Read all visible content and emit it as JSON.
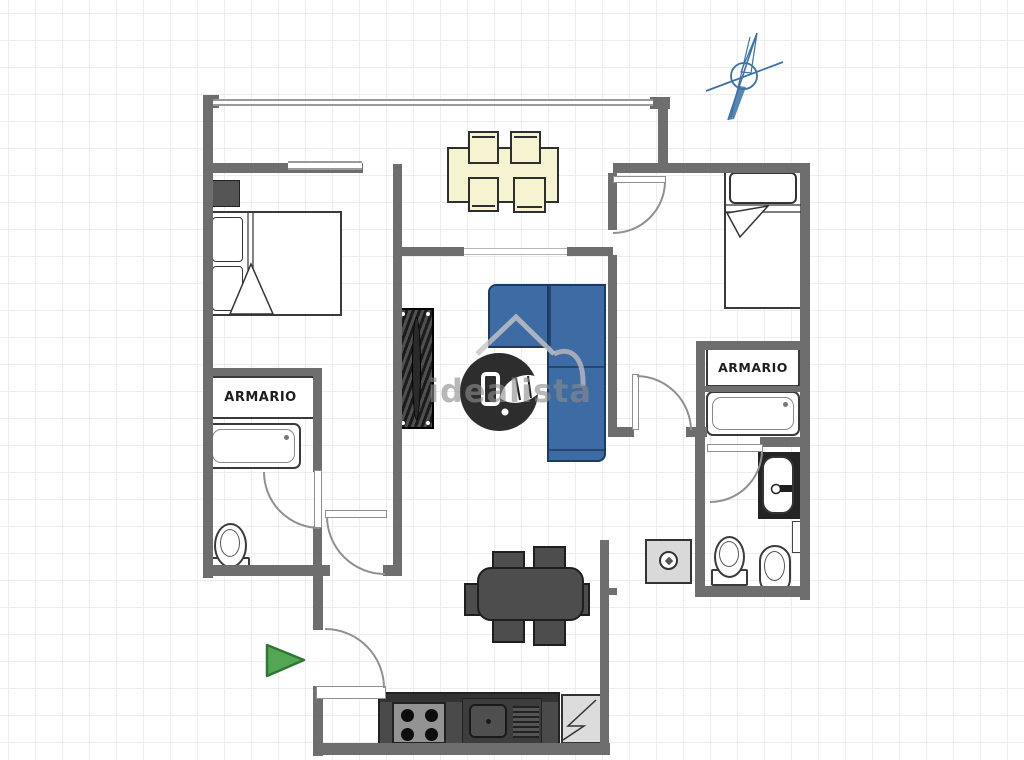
{
  "title": "Apartment floor plan",
  "labels": {
    "closet_left": "ARMARIO",
    "closet_right": "ARMARIO"
  },
  "watermark": {
    "text": "idealista"
  },
  "colors": {
    "wall": "#6e6e6e",
    "wall_light": "#9a9a9a",
    "outline": "#333333",
    "sofa_blue": "#3d6ba3",
    "cream_table": "#f5f3d0",
    "dark_furniture": "#4d4d4d",
    "kitchen_counter": "#4a4a4a",
    "appliance_light": "#dcdcdc",
    "entrance_green": "#54a554",
    "compass_blue": "#3a72a8",
    "watermark_gray": "#969696"
  },
  "icons": {
    "compass": "north-compass-icon",
    "entrance_arrow": "entrance-arrow-icon",
    "watermark_logo": "idealista-logo-icon"
  }
}
